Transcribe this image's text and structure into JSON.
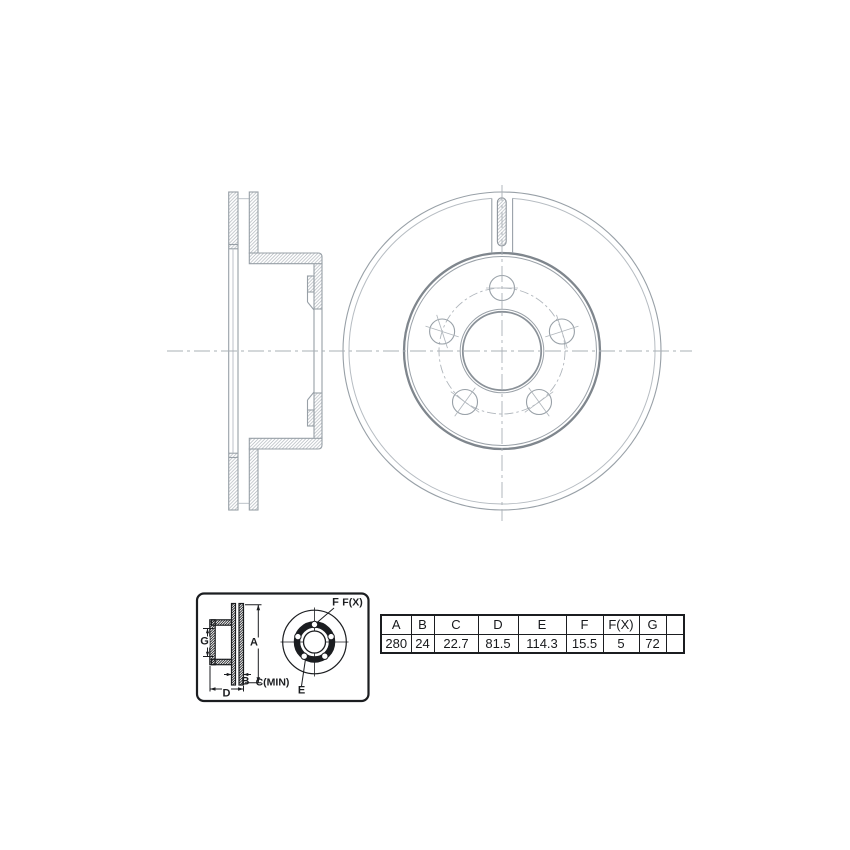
{
  "palette": {
    "background": "#ffffff",
    "drawing_line": "#98a0a7",
    "drawing_light": "#b6bcc2",
    "drawing_heavy": "#7f868d",
    "ink_black": "#1b1d20"
  },
  "dimension_labels": {
    "G": "G",
    "A": "A",
    "B": "B",
    "C_MIN": "C(MIN)",
    "D": "D",
    "E": "E",
    "F": "F",
    "F_X": "F(X)"
  },
  "spec_table": {
    "columns": [
      "A",
      "B",
      "C",
      "D",
      "E",
      "F",
      "F(X)",
      "G",
      ""
    ],
    "values": [
      "280",
      "24",
      "22.7",
      "81.5",
      "114.3",
      "15.5",
      "5",
      "72",
      ""
    ]
  }
}
